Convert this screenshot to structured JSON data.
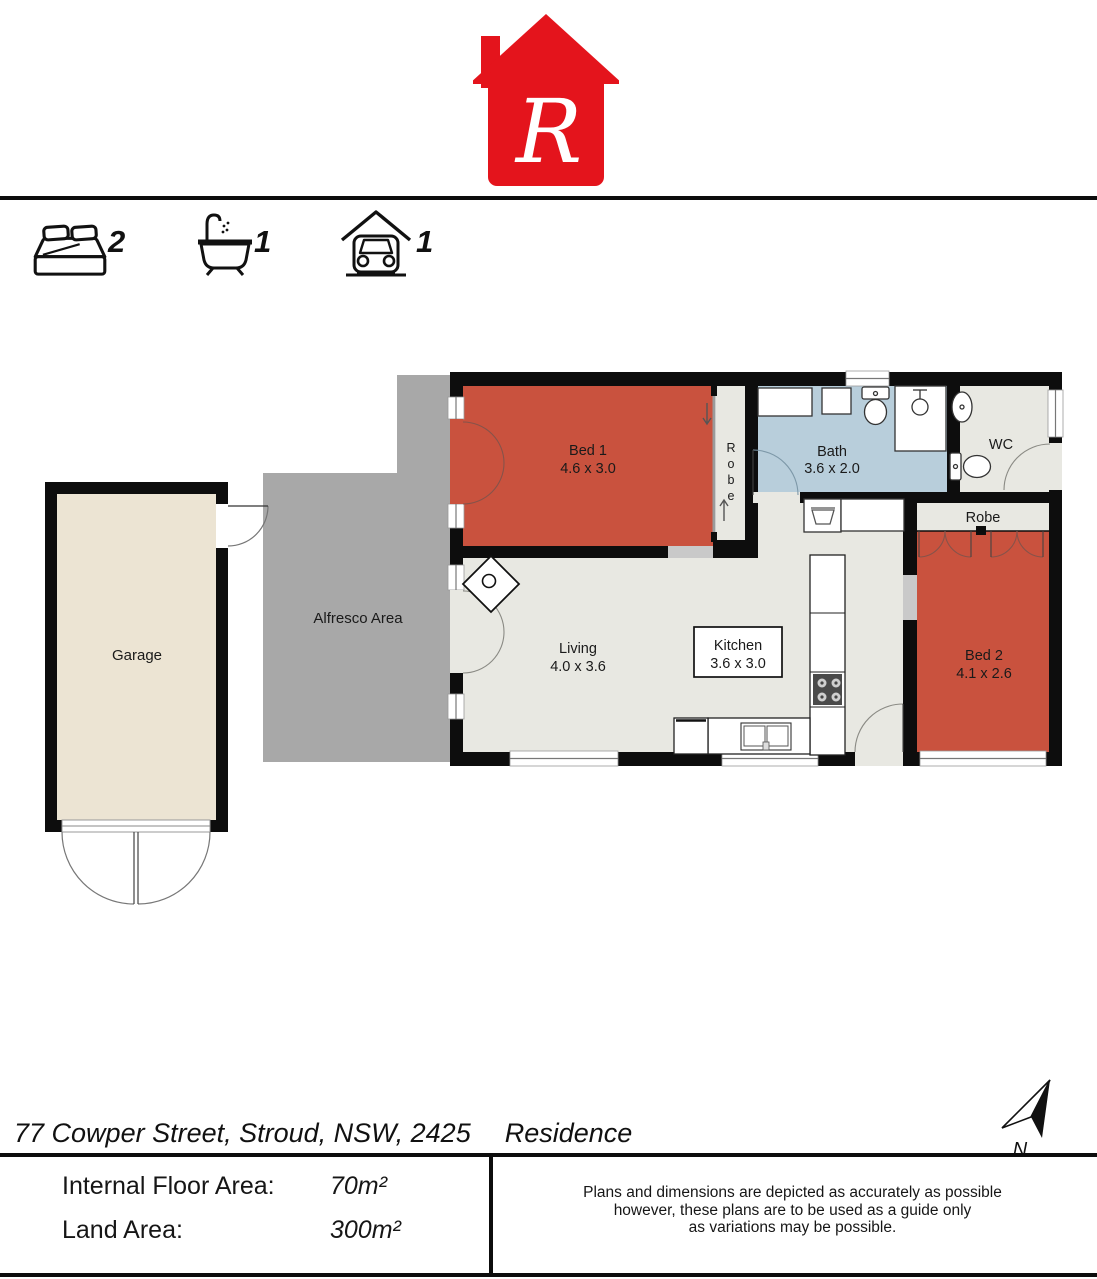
{
  "logo": {
    "letter": "R",
    "color": "#e4141c"
  },
  "summary": {
    "beds": "2",
    "baths": "1",
    "cars": "1"
  },
  "plan": {
    "rooms": {
      "bed1": {
        "name": "Bed 1",
        "dims": "4.6 x 3.0"
      },
      "bed2": {
        "name": "Bed 2",
        "dims": "4.1 x 2.6"
      },
      "bath": {
        "name": "Bath",
        "dims": "3.6 x 2.0"
      },
      "living": {
        "name": "Living",
        "dims": "4.0 x 3.6"
      },
      "kitchen": {
        "name": "Kitchen",
        "dims": "3.6 x 3.0"
      },
      "wc": "WC",
      "robe1_letters": [
        "R",
        "o",
        "b",
        "e"
      ],
      "robe2": "Robe",
      "garage": "Garage",
      "alfresco": "Alfresco Area"
    },
    "north_label": "N",
    "colors": {
      "bedroom": "#c9523e",
      "bath": "#b8cedb",
      "floor": "#e8e8e2",
      "garage_floor": "#ece4d3",
      "alfresco": "#a8a8a8",
      "wall": "#0d0d0d"
    }
  },
  "address": {
    "street": "77 Cowper Street, Stroud, NSW, 2425",
    "type": "Residence"
  },
  "details": {
    "floor_label": "Internal Floor Area:",
    "floor_value": "70m²",
    "land_label": "Land Area:",
    "land_value": "300m²"
  },
  "disclaimer": {
    "line1": "Plans and dimensions are depicted as accurately as possible",
    "line2": "however, these plans are to be used as a guide only",
    "line3": "as variations may be possible."
  }
}
